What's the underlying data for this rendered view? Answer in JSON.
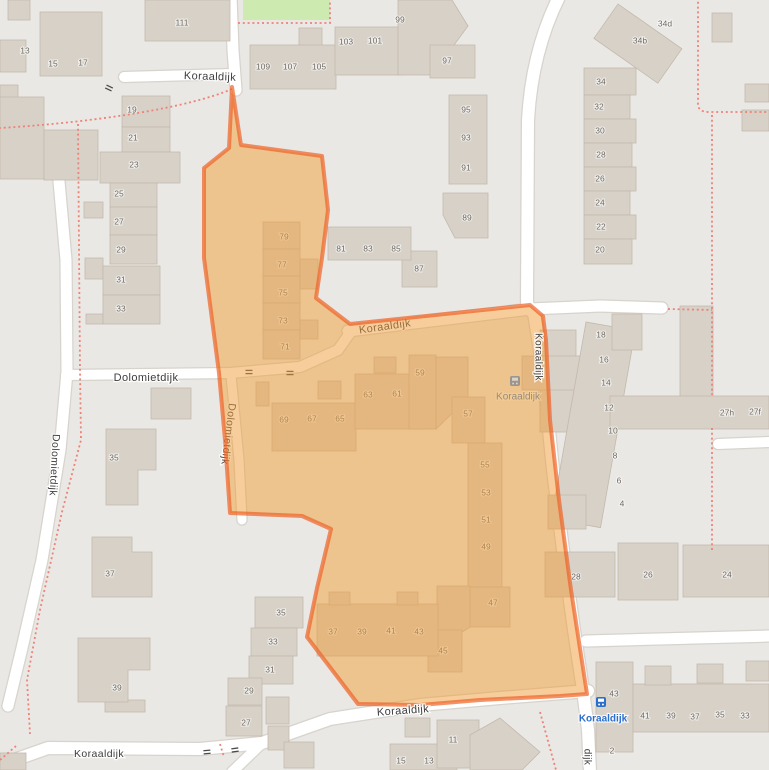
{
  "map": {
    "width": 769,
    "height": 770,
    "colors": {
      "bg": "#eae8e4",
      "building": "#d8d1c8",
      "building_stroke": "#c3b9ad",
      "road": "#ffffff",
      "road_casing": "#d7d3cd",
      "green": "#cdebb0",
      "path": "#ee8277",
      "highlight_fill": "rgba(240,158,55,0.5)",
      "highlight_stroke": "rgba(238,98,38,0.7)",
      "housenumber": "#6e6860",
      "street_label": "#3d3d3d",
      "street_halo": "rgba(255,255,255,0.85)",
      "bus_blue": "#2b6fce",
      "bus_muted_icon": "#9b958d",
      "bus_muted_text": "#98897b",
      "traffic_mark": "#4a4a4a"
    },
    "green_areas": [
      {
        "x": 243,
        "y": 0,
        "w": 87,
        "h": 20
      }
    ],
    "roads": [
      {
        "d": "M 231,-4 L 233,50 L 236,90",
        "w": 11
      },
      {
        "d": "M 124,77 L 232,74",
        "w": 10
      },
      {
        "d": "M -4,113 C 30,122 52,138 58,170 L 66,260 L 67,372 L 60,450 L 42,560 L 22,648 L 8,706",
        "w": 11
      },
      {
        "d": "M 0,765 L 48,748 L 200,749 L 262,743 L 330,719 L 420,705 L 500,698 L 588,691",
        "w": 12
      },
      {
        "d": "M 262,743 L 232,772",
        "w": 10
      },
      {
        "d": "M 66,375 L 230,373 L 300,367 L 338,350 L 352,330",
        "w": 10
      },
      {
        "d": "M 231,375 L 239,460 L 242,520",
        "w": 9
      },
      {
        "d": "M 348,331 L 530,309 L 600,306 L 662,308",
        "w": 11
      },
      {
        "d": "M 560,-5 Q 532,50 528,120 L 527,300 Q 527,309 534,313 L 543,370 L 553,470 L 563,550 L 574,630 L 583,690 L 588,730 L 590,772",
        "w": 12
      },
      {
        "d": "M 586,641 L 770,636",
        "w": 11
      },
      {
        "d": "M 718,444 L 770,442",
        "w": 10
      }
    ],
    "paths": [
      {
        "d": "M 238,23 L 330,23 L 330,-3"
      },
      {
        "d": "M 232,89 C 190,107 100,122 0,128"
      },
      {
        "d": "M 78,124 L 80,370 L 81,440 L 62,512 L 40,610 L 27,680 L 30,734"
      },
      {
        "d": "M 16,746 L 0,760"
      },
      {
        "d": "M 698,-3 L 698,104 Q 698,112 709,112 L 770,112"
      },
      {
        "d": "M 668,309 L 712,310"
      },
      {
        "d": "M 712,115 L 712,395 M 712,428 L 712,550"
      },
      {
        "d": "M 540,712 L 556,770"
      },
      {
        "d": "M 220,744 L 224,757"
      }
    ],
    "buildings": [
      [
        8,
        0,
        22,
        20
      ],
      [
        0,
        40,
        26,
        32
      ],
      [
        0,
        85,
        18,
        55
      ],
      [
        0,
        97,
        44,
        82
      ],
      [
        44,
        130,
        54,
        50
      ],
      [
        40,
        12,
        62,
        64
      ],
      [
        145,
        0,
        85,
        41
      ],
      [
        299,
        28,
        23,
        18
      ],
      [
        250,
        45,
        86,
        44
      ],
      [
        335,
        27,
        66,
        48
      ],
      {
        "pts": "398,0 452,0 468,26 432,75 398,75"
      },
      [
        430,
        45,
        45,
        33
      ],
      [
        449,
        95,
        38,
        89
      ],
      {
        "pts": "443,193 488,193 488,238 455,238 443,215"
      },
      [
        402,
        251,
        35,
        36
      ],
      [
        328,
        227,
        83,
        33
      ],
      [
        618,
        4,
        78,
        42,
        35
      ],
      [
        712,
        13,
        20,
        29
      ],
      [
        745,
        84,
        24,
        18
      ],
      [
        742,
        110,
        27,
        21
      ],
      [
        584,
        68,
        52,
        27
      ],
      [
        584,
        95,
        46,
        24
      ],
      [
        584,
        119,
        52,
        24
      ],
      [
        584,
        143,
        48,
        24
      ],
      [
        584,
        167,
        52,
        24
      ],
      [
        584,
        191,
        46,
        24
      ],
      [
        584,
        215,
        52,
        24
      ],
      [
        584,
        239,
        48,
        25
      ],
      [
        540,
        330,
        36,
        102
      ],
      [
        522,
        356,
        70,
        34
      ],
      [
        586,
        322,
        50,
        200,
        10
      ],
      [
        680,
        306,
        33,
        92
      ],
      [
        612,
        314,
        30,
        36
      ],
      [
        610,
        396,
        159,
        33
      ],
      [
        548,
        495,
        38,
        34
      ],
      [
        545,
        552,
        70,
        45
      ],
      [
        618,
        543,
        60,
        57
      ],
      [
        683,
        545,
        86,
        52
      ],
      [
        596,
        662,
        37,
        90
      ],
      [
        633,
        684,
        136,
        48
      ],
      [
        645,
        666,
        26,
        19
      ],
      [
        697,
        664,
        26,
        19
      ],
      [
        746,
        661,
        23,
        20
      ],
      [
        255,
        597,
        48,
        31
      ],
      [
        251,
        628,
        46,
        28
      ],
      [
        249,
        656,
        44,
        28
      ],
      [
        228,
        678,
        34,
        27
      ],
      [
        226,
        706,
        36,
        30
      ],
      [
        266,
        697,
        23,
        27
      ],
      [
        268,
        726,
        21,
        24
      ],
      [
        284,
        742,
        30,
        26
      ],
      [
        105,
        700,
        40,
        12
      ],
      [
        0,
        753,
        26,
        17
      ],
      [
        390,
        744,
        67,
        26
      ],
      [
        405,
        718,
        25,
        19
      ],
      [
        437,
        720,
        42,
        48
      ],
      {
        "pts": "470,770 470,735 500,718 540,752 522,770"
      },
      [
        151,
        388,
        40,
        31
      ],
      {
        "pts": "106,429 156,429 156,470 138,470 138,505 106,505"
      },
      {
        "pts": "92,537 132,537 132,552 152,552 152,597 92,597"
      },
      {
        "pts": "78,638 150,638 150,670 128,670 128,702 78,702"
      },
      [
        84,
        202,
        19,
        16
      ],
      [
        85,
        258,
        18,
        21
      ],
      [
        86,
        314,
        17,
        10
      ],
      [
        122,
        96,
        48,
        31
      ],
      [
        122,
        127,
        48,
        25
      ],
      [
        100,
        152,
        80,
        31
      ],
      [
        110,
        183,
        47,
        24
      ],
      [
        110,
        207,
        47,
        28
      ],
      [
        110,
        235,
        47,
        29
      ],
      [
        103,
        266,
        57,
        29
      ],
      [
        103,
        295,
        57,
        29
      ],
      [
        263,
        222,
        37,
        27
      ],
      [
        263,
        249,
        37,
        27
      ],
      [
        263,
        276,
        37,
        27
      ],
      [
        263,
        303,
        37,
        27
      ],
      [
        263,
        330,
        37,
        29
      ],
      [
        300,
        259,
        18,
        30
      ],
      [
        300,
        320,
        18,
        19
      ],
      [
        256,
        382,
        13,
        24
      ],
      [
        318,
        381,
        23,
        18
      ],
      [
        272,
        403,
        84,
        48
      ],
      [
        355,
        374,
        71,
        55
      ],
      [
        374,
        357,
        22,
        16
      ],
      [
        409,
        355,
        27,
        74
      ],
      {
        "pts": "436,357 468,357 468,398 436,429"
      },
      [
        452,
        397,
        33,
        46
      ],
      [
        468,
        443,
        34,
        144
      ],
      [
        470,
        587,
        40,
        40
      ],
      {
        "pts": "437,586 470,586 470,627 437,648"
      },
      [
        428,
        630,
        34,
        42
      ],
      [
        317,
        604,
        121,
        52
      ],
      [
        329,
        592,
        21,
        13
      ],
      [
        397,
        592,
        21,
        13
      ]
    ],
    "traffic_marks": [
      {
        "x": 109,
        "y": 88,
        "rot": 25
      },
      {
        "x": 249,
        "y": 372,
        "rot": 0
      },
      {
        "x": 290,
        "y": 373,
        "rot": 0
      },
      {
        "x": 207,
        "y": 752,
        "rot": -5
      },
      {
        "x": 235,
        "y": 750,
        "rot": -8
      }
    ],
    "house_numbers": [
      [
        "13",
        25,
        51
      ],
      [
        "15",
        53,
        64
      ],
      [
        "17",
        83,
        63
      ],
      [
        "111",
        182,
        23
      ],
      [
        "109",
        263,
        67
      ],
      [
        "107",
        290,
        67
      ],
      [
        "105",
        319,
        67
      ],
      [
        "103",
        346,
        42
      ],
      [
        "101",
        375,
        41
      ],
      [
        "99",
        400,
        20
      ],
      [
        "97",
        447,
        61
      ],
      [
        "95",
        466,
        110
      ],
      [
        "93",
        466,
        138
      ],
      [
        "91",
        466,
        168
      ],
      [
        "89",
        467,
        218
      ],
      [
        "87",
        419,
        269
      ],
      [
        "81",
        341,
        249
      ],
      [
        "83",
        368,
        249
      ],
      [
        "85",
        396,
        249
      ],
      [
        "19",
        132,
        110
      ],
      [
        "21",
        133,
        138
      ],
      [
        "23",
        134,
        165
      ],
      [
        "25",
        119,
        194
      ],
      [
        "27",
        119,
        222
      ],
      [
        "29",
        121,
        250
      ],
      [
        "31",
        121,
        280
      ],
      [
        "33",
        121,
        309
      ],
      [
        "35",
        114,
        458
      ],
      [
        "37",
        110,
        574
      ],
      [
        "39",
        117,
        688
      ],
      [
        "34d",
        665,
        24
      ],
      [
        "34b",
        640,
        41
      ],
      [
        "34",
        601,
        82
      ],
      [
        "32",
        599,
        107
      ],
      [
        "30",
        600,
        131
      ],
      [
        "28",
        601,
        155
      ],
      [
        "26",
        600,
        179
      ],
      [
        "24",
        600,
        203
      ],
      [
        "22",
        601,
        227
      ],
      [
        "20",
        600,
        250
      ],
      [
        "18",
        601,
        335
      ],
      [
        "16",
        604,
        360
      ],
      [
        "14",
        606,
        383
      ],
      [
        "12",
        609,
        408
      ],
      [
        "10",
        613,
        431
      ],
      [
        "8",
        615,
        456
      ],
      [
        "6",
        619,
        481
      ],
      [
        "4",
        622,
        504
      ],
      [
        "27h",
        727,
        413
      ],
      [
        "27f",
        755,
        412
      ],
      [
        "28",
        576,
        577
      ],
      [
        "26",
        648,
        575
      ],
      [
        "24",
        727,
        575
      ],
      [
        "43",
        614,
        694
      ],
      [
        "41",
        645,
        716
      ],
      [
        "39",
        671,
        716
      ],
      [
        "37",
        695,
        717
      ],
      [
        "35",
        720,
        715
      ],
      [
        "33",
        745,
        716
      ],
      [
        "2",
        612,
        751
      ],
      [
        "35",
        281,
        613
      ],
      [
        "33",
        273,
        642
      ],
      [
        "31",
        270,
        670
      ],
      [
        "29",
        249,
        691
      ],
      [
        "27",
        246,
        723
      ],
      [
        "15",
        401,
        761
      ],
      [
        "13",
        429,
        761
      ],
      [
        "11",
        453,
        740
      ],
      [
        "79",
        284,
        237
      ],
      [
        "77",
        282,
        265
      ],
      [
        "75",
        283,
        293
      ],
      [
        "73",
        283,
        321
      ],
      [
        "71",
        285,
        347
      ],
      [
        "69",
        284,
        420
      ],
      [
        "67",
        312,
        419
      ],
      [
        "65",
        340,
        419
      ],
      [
        "63",
        368,
        395
      ],
      [
        "61",
        397,
        394
      ],
      [
        "59",
        420,
        373
      ],
      [
        "57",
        468,
        414
      ],
      [
        "55",
        485,
        465
      ],
      [
        "53",
        486,
        493
      ],
      [
        "51",
        486,
        520
      ],
      [
        "49",
        486,
        547
      ],
      [
        "47",
        493,
        603
      ],
      [
        "45",
        443,
        651
      ],
      [
        "43",
        419,
        632
      ],
      [
        "41",
        391,
        631
      ],
      [
        "39",
        362,
        632
      ],
      [
        "37",
        333,
        632
      ]
    ],
    "street_labels_under": [
      {
        "t": "Koraaldijk",
        "x": 385,
        "y": 327,
        "rot": -8,
        "size": 11
      },
      {
        "t": "Dolomietdijk",
        "x": 228,
        "y": 434,
        "rot": 97,
        "size": 10.5
      }
    ],
    "street_labels_over": [
      {
        "t": "Koraaldijk",
        "x": 210,
        "y": 77,
        "rot": 2,
        "size": 11
      },
      {
        "t": "Koraaldijk",
        "x": 538,
        "y": 357,
        "rot": 90,
        "size": 10
      },
      {
        "t": "Dolomietdijk",
        "x": 146,
        "y": 378,
        "rot": 0,
        "size": 11
      },
      {
        "t": "Dolomietdijk",
        "x": 54,
        "y": 465,
        "rot": 93,
        "size": 10.5
      },
      {
        "t": "Koraaldijk",
        "x": 403,
        "y": 711,
        "rot": -4,
        "size": 11
      },
      {
        "t": "Koraaldijk",
        "x": 99,
        "y": 754,
        "rot": 0,
        "size": 10.5
      },
      {
        "t": "dijk",
        "x": 587,
        "y": 757,
        "rot": 90,
        "size": 10
      }
    ],
    "highlight": {
      "points": "232,87 241,145 322,156 328,210 322,258 316,298 350,324 530,305 543,316 546,340 550,420 559,500 571,590 581,655 587,694 560,696 480,700 420,705 358,704 307,637 317,588 331,529 302,516 230,513 225,440 219,373 204,258 204,168 229,148"
    },
    "bus_stops": [
      {
        "x": 515,
        "y": 381,
        "label": "Koraaldijk",
        "lx": 518,
        "ly": 397,
        "muted": true
      },
      {
        "x": 601,
        "y": 702,
        "label": "Koraaldijk",
        "lx": 603,
        "ly": 719,
        "muted": false
      }
    ]
  }
}
